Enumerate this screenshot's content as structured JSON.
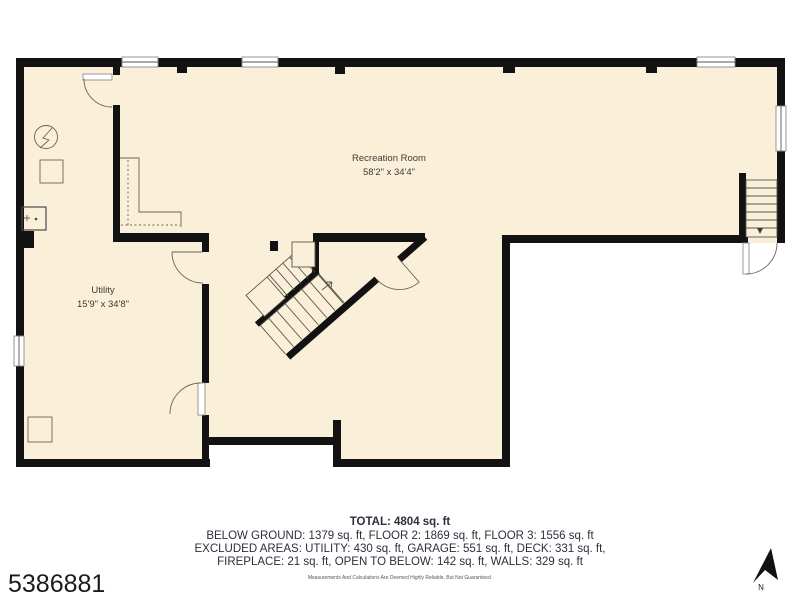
{
  "palette": {
    "background": "#ffffff",
    "floor_fill": "#faf0da",
    "wall_color": "#121212",
    "thin_line_color": "#5a544a",
    "room_label_color": "#3f3a31",
    "summary_text_color": "#2e2e3c",
    "listing_text_color": "#1b1b1b"
  },
  "rooms": [
    {
      "name": "Recreation Room",
      "dimensions": "58'2\" x 34'4\""
    },
    {
      "name": "Utility",
      "dimensions": "15'9\" x 34'8\""
    }
  ],
  "summary": {
    "total": "TOTAL: 4804 sq. ft",
    "line1": "BELOW GROUND: 1379 sq. ft, FLOOR 2: 1869 sq. ft, FLOOR 3: 1556 sq. ft",
    "line2": "EXCLUDED AREAS: UTILITY: 430 sq. ft, GARAGE: 551 sq. ft, DECK: 331 sq. ft,",
    "line3": "FIREPLACE: 21 sq. ft, OPEN TO BELOW: 142 sq. ft, WALLS: 329 sq. ft",
    "disclaimer": "Measurements And Calculations Are Deemed Highly Reliable, But Not Guaranteed."
  },
  "listing_id": "5386881",
  "compass": {
    "label": "N"
  }
}
